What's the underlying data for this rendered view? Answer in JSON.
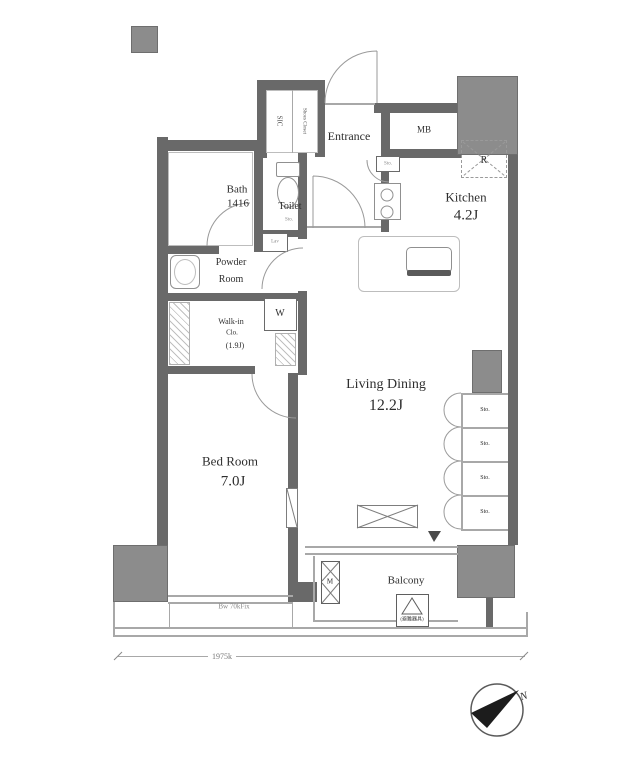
{
  "plan": {
    "rooms": {
      "entrance": {
        "label": "Entrance"
      },
      "mb": {
        "label": "MB"
      },
      "fridge": {
        "label": "R"
      },
      "kitchen": {
        "name": "Kitchen",
        "size": "4.2J"
      },
      "bath": {
        "name": "Bath",
        "size": "1416"
      },
      "toilet": {
        "name": "Toilet",
        "note": "Sto."
      },
      "lav": {
        "label": "Lav"
      },
      "powder": {
        "line1": "Powder",
        "line2": "Room"
      },
      "walkin": {
        "line1": "Walk-in",
        "line2": "Clo.",
        "size": "(1.9J)"
      },
      "washer": {
        "label": "W"
      },
      "living": {
        "name": "Living Dining",
        "size": "12.2J"
      },
      "bedroom": {
        "name": "Bed Room",
        "size": "7.0J"
      },
      "balcony": {
        "label": "Balcony"
      },
      "meter": {
        "label": "M"
      },
      "shoes": {
        "left": "SIC",
        "right": "Shoes Closet"
      },
      "hall_shelf": {
        "label": "Sto."
      }
    },
    "storage_cells": [
      "Sto.",
      "Sto.",
      "Sto.",
      "Sto."
    ],
    "annotations": {
      "window_note": "Bw 70kFix",
      "dimension": "1975k",
      "hatch": "(避難器具)",
      "compass_n": "N"
    },
    "colors": {
      "wall": "#696969",
      "pillar": "#8c8c8c",
      "line": "#a8a8a8",
      "text": "#2e2e2e"
    }
  }
}
